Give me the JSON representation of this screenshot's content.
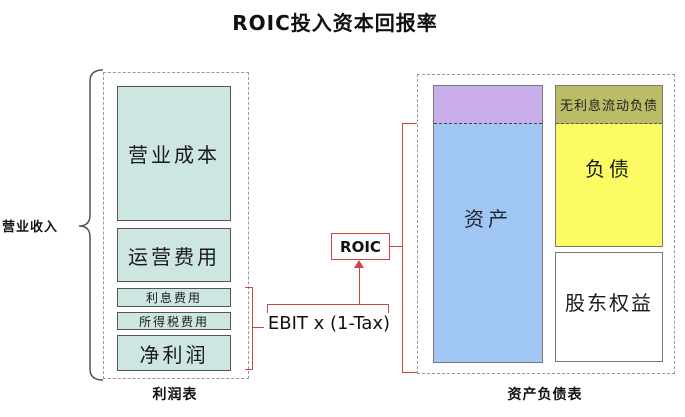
{
  "title": "ROIC投入资本回报率",
  "income_statement": {
    "bracket_label": "营业收入",
    "caption": "利润表",
    "items": [
      {
        "label": "营业成本"
      },
      {
        "label": "运营费用"
      },
      {
        "label": "利息费用"
      },
      {
        "label": "所得税费用"
      },
      {
        "label": "净利润"
      }
    ]
  },
  "formula": {
    "roic_label": "ROIC",
    "ebit_label": "EBIT x (1-Tax)"
  },
  "balance_sheet": {
    "caption": "资产负债表",
    "noninterest_liabilities_label": "无利息流动负债",
    "assets_label": "资产",
    "liabilities_label": "负债",
    "equity_label": "股东权益"
  },
  "colors": {
    "income_box_fill": "#cde6e2",
    "assets_fill": "#a0c6f4",
    "assets_top_fill": "#c9aeea",
    "liabilities_fill": "#fbfb63",
    "noninterest_fill": "#bcbc66",
    "connector_red": "#cc4444",
    "dashed_border_gray": "#999999"
  }
}
